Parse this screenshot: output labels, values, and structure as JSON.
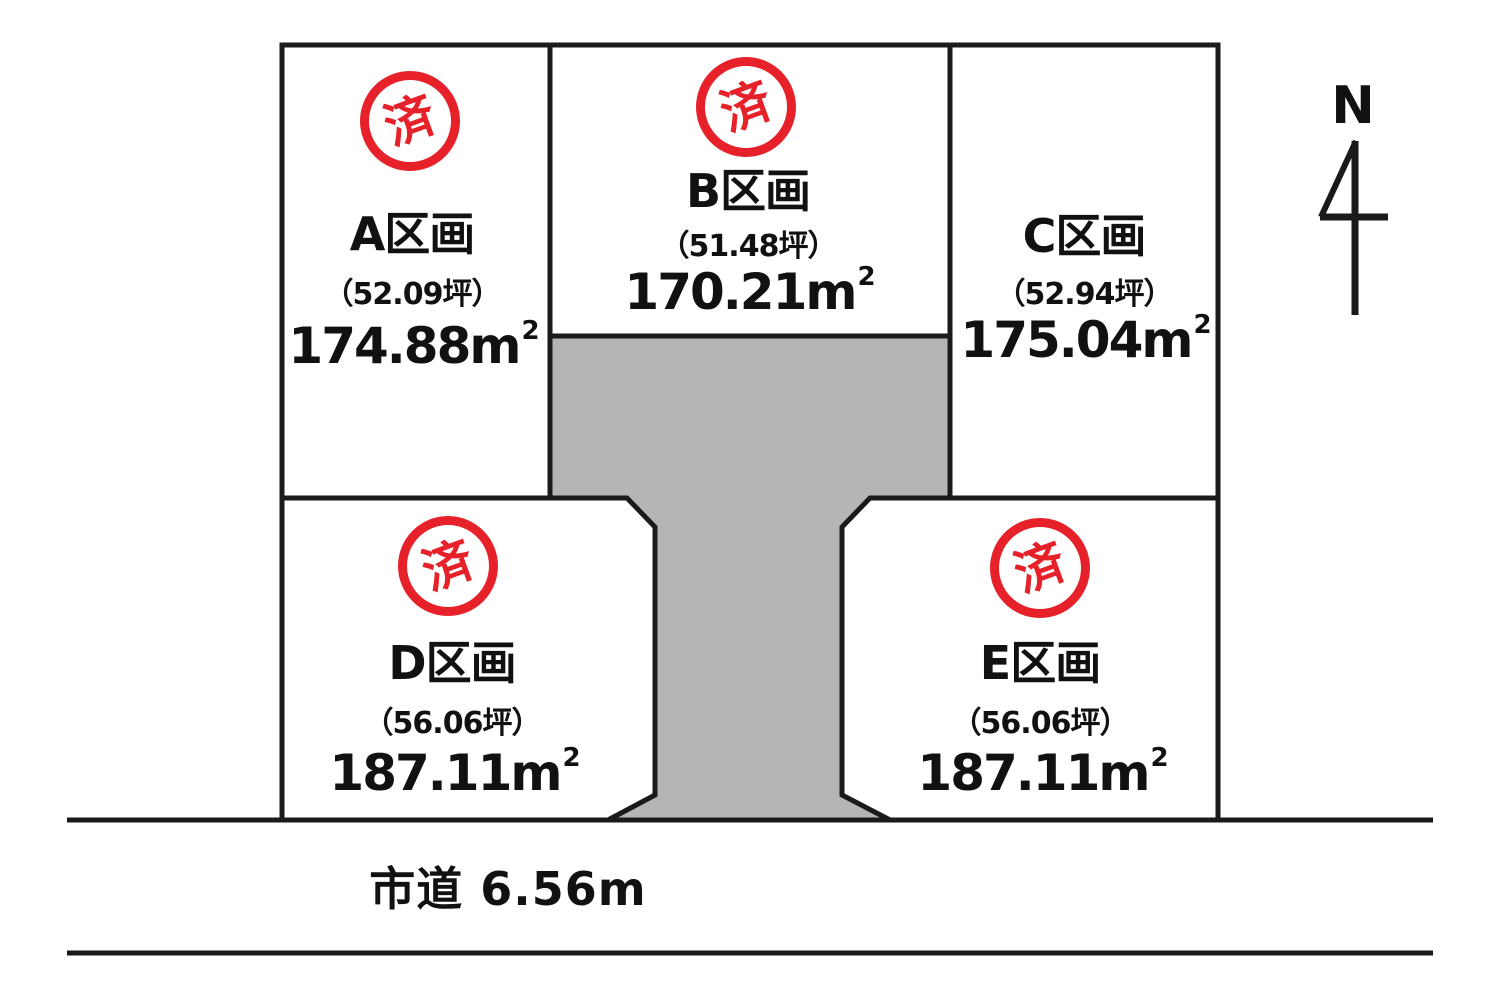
{
  "plots": [
    {
      "name": "A区画",
      "tsubo": "（52.09坪）",
      "area": "174.88",
      "sold": true
    },
    {
      "name": "B区画",
      "tsubo": "（51.48坪）",
      "area": "170.21",
      "sold": true
    },
    {
      "name": "C区画",
      "tsubo": "（52.94坪）",
      "area": "175.04",
      "sold": false
    },
    {
      "name": "D区画",
      "tsubo": "（56.06坪）",
      "area": "187.11",
      "sold": true
    },
    {
      "name": "E区画",
      "tsubo": "（56.06坪）",
      "area": "187.11",
      "sold": true
    }
  ],
  "sold_badge_label": "済",
  "area_unit": {
    "base": "m",
    "sup": "2"
  },
  "road_label": "市道 6.56m",
  "compass_label": "N",
  "colors": {
    "badge_red": "#e62129",
    "line": "#1a1a1a",
    "driveway_gray": "#b5b5b5"
  }
}
